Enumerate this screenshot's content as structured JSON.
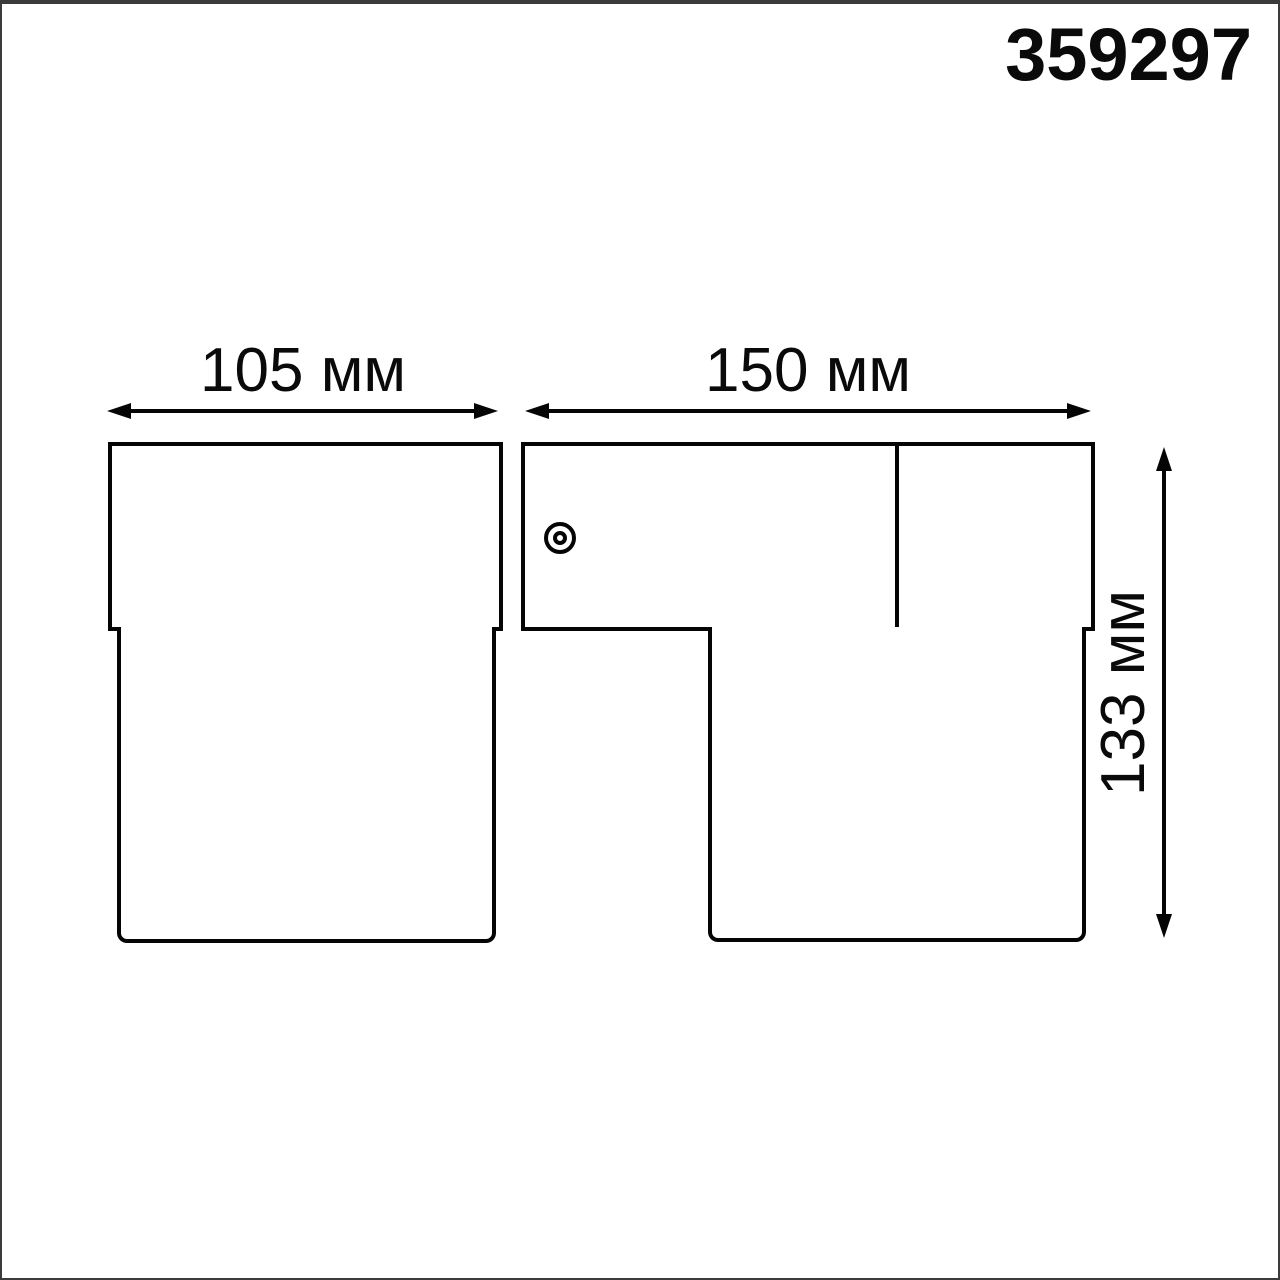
{
  "product_code": "359297",
  "dimensions": {
    "width_left": "105 мм",
    "width_right": "150 мм",
    "height_right": "133 мм"
  },
  "colors": {
    "line": "#050505",
    "text": "#0a0a0a",
    "background": "#ffffff",
    "frame": "#3b3b3b"
  },
  "icons": {
    "screw_icon": "double-concentric-circle"
  }
}
